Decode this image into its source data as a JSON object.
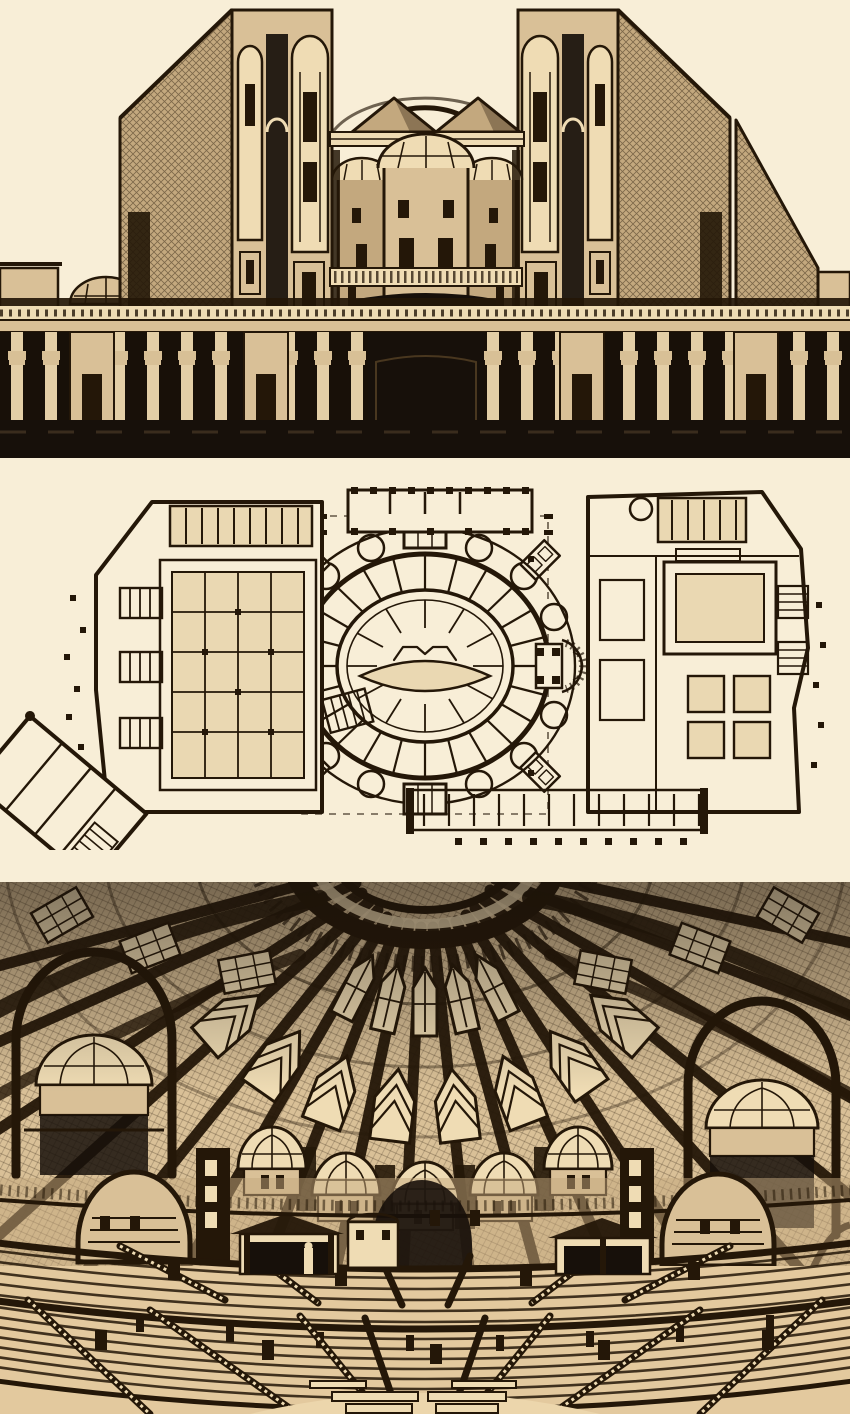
{
  "panels": [
    {
      "id": "exterior-elevation",
      "kind": "architectural-elevation-drawing"
    },
    {
      "id": "floor-plan",
      "kind": "architectural-plan-drawing"
    },
    {
      "id": "interior-perspective",
      "kind": "architectural-interior-drawing"
    }
  ],
  "colors": {
    "paper": "#f8eed7",
    "sepia": "#d9c097",
    "sepia2": "#c3a87e",
    "seat": "#e3c99e",
    "wash": "#ead8b2",
    "highlight": "#efdcb4",
    "ink": "#241708",
    "ink_soft": "#49371f",
    "dark": "#17100a"
  }
}
